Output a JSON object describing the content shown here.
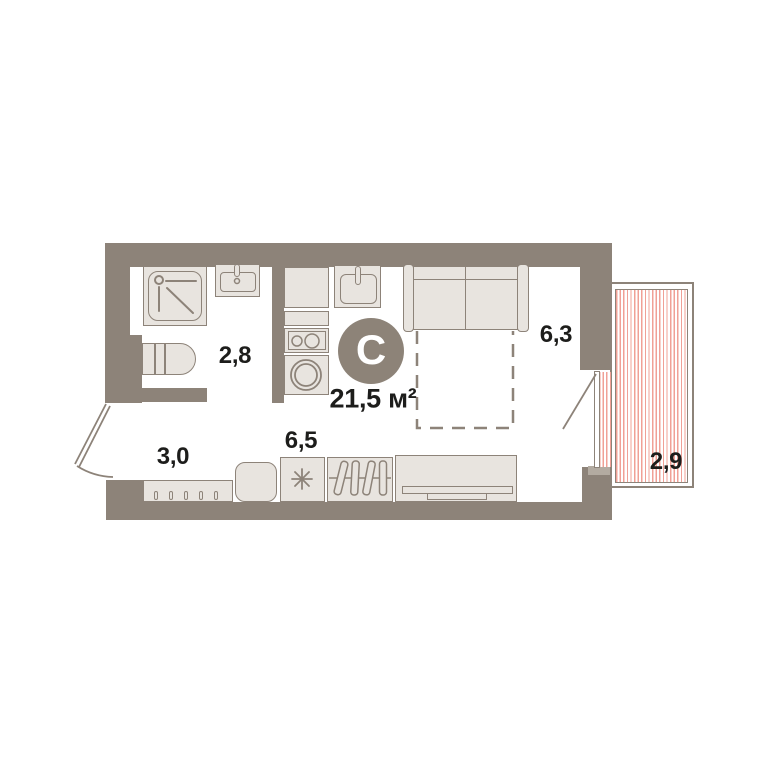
{
  "plan": {
    "type_badge": "С",
    "total_area": "21,5 м²",
    "rooms": {
      "bathroom": "2,8",
      "hallway": "3,0",
      "kitchen": "6,5",
      "living": "6,3",
      "balcony": "2,9"
    },
    "icons": {
      "badge": "studio-type-badge",
      "fridge": "snowflake-icon",
      "shower": "shower-head-icon",
      "cooktop": "burners-icon",
      "washer": "drum-icon",
      "doors": "door-swing-icon"
    },
    "colors": {
      "wall": "#8d8379",
      "fixture_fill": "#e8e4df",
      "fixture_border": "#8d8379",
      "balcony_hatch": "#f0a096",
      "text": "#1d1d1b",
      "badge_fill": "#8d8378",
      "badge_letter": "#ffffff"
    }
  }
}
